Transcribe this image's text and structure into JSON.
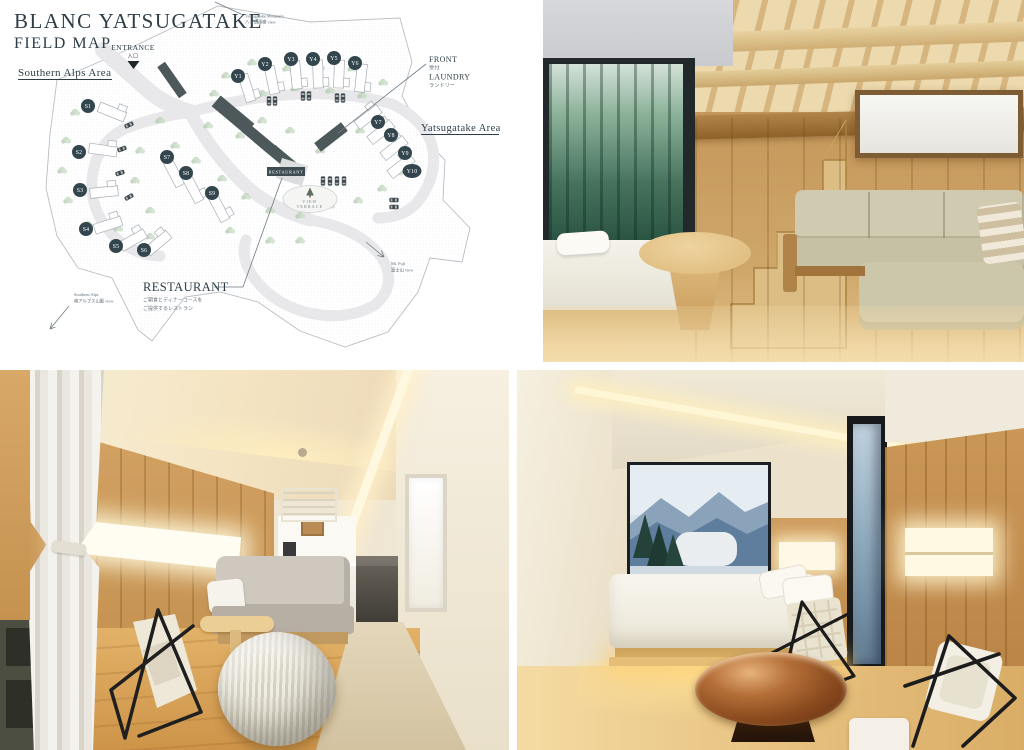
{
  "map": {
    "title": "BLANC YATSUGATAKE",
    "subtitle": "FIELD MAP",
    "entrance_label": "ENTRANCE",
    "entrance_label_jp": "入口",
    "area_southern_alps": "Southern Alps Area",
    "area_yatsugatake": "Yatsugatake Area",
    "front_label": "FRONT",
    "front_label_jp": "受付",
    "laundry_label": "LAUNDRY",
    "laundry_label_jp": "ランドリー",
    "restaurant_label": "RESTAURANT",
    "restaurant_note_1": "ご朝食とディナーコースを",
    "restaurant_note_2": "ご提供するレストラン",
    "restaurant_building_label": "RESTAURANT",
    "view_terrace_1": "VIEW",
    "view_terrace_2": "TERRACE",
    "view_yatsugatake_1": "Yatsugatake Mountain",
    "view_yatsugatake_2": "八ヶ岳連峰 view",
    "view_southern_alps_1": "Southern Alps",
    "view_southern_alps_2": "南アルプス山脈 view",
    "view_fuji_1": "Mt. Fuji",
    "view_fuji_2": "富士山 view",
    "cabins_south": [
      "S1",
      "S2",
      "S3",
      "S4",
      "S5",
      "S6",
      "S7",
      "S8",
      "S9"
    ],
    "cabins_yatsugatake": [
      "Y1",
      "Y2",
      "Y3",
      "Y4",
      "Y5",
      "Y6",
      "Y7",
      "Y8",
      "Y9",
      "Y10"
    ],
    "colors": {
      "ink": "#2e3d46",
      "badge": "#33464d",
      "road": "#e7e7ea",
      "tree": "#bcd2b8",
      "building": "#4d585a"
    }
  },
  "photos": {
    "loft_room": {
      "alt": "Loft cabin interior: wood staircase, forest window, beige corner sofa"
    },
    "living_room": {
      "alt": "Cabin living room: curtain, wood wall with lit niche, gray sofa, wire chair, knit pouf"
    },
    "bedroom": {
      "alt": "Cabin bedroom at dusk: mountain view window, low white bed, round wood table, wire chairs"
    }
  }
}
